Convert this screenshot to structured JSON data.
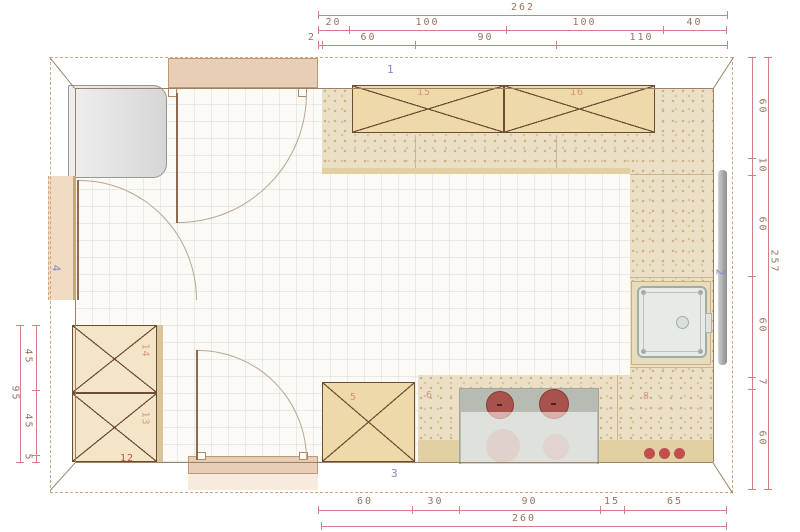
{
  "plan_title": "kitchen-floor-plan",
  "wall_labels": {
    "top": "1",
    "right": "2",
    "bottom": "3",
    "left": "4"
  },
  "item_labels": {
    "upper_cabinet_a": "15",
    "upper_cabinet_b": "16",
    "tall_cabinet_top": "14",
    "tall_cabinet_bottom": "13",
    "base_plinth": "12",
    "counter_left": "5",
    "counter_mid": "6",
    "counter_right": "8"
  },
  "dimensions": {
    "top": {
      "total": "262",
      "outer": [
        "20",
        "100",
        "100",
        "40"
      ],
      "inner": [
        "2",
        "60",
        "90",
        "110"
      ]
    },
    "right": {
      "total": "257",
      "segments": [
        "60",
        "10",
        "60",
        "60",
        "7",
        "60"
      ]
    },
    "left": {
      "total": "95",
      "segments": [
        "45",
        "45",
        "5"
      ]
    },
    "bottom": {
      "total": "260",
      "segments": [
        "60",
        "30",
        "90",
        "15",
        "65"
      ]
    }
  },
  "colors": {
    "dimension_line": "#d08080",
    "dimension_text": "#9b7060",
    "wall_label_blue": "#8087cf",
    "item_label_red": "#c8524a",
    "counter_speckle": "#ebdfc6",
    "cabinet_wheat": "#eed9a9",
    "burner_red": "#a8524b",
    "knob_red": "#c0504d"
  }
}
